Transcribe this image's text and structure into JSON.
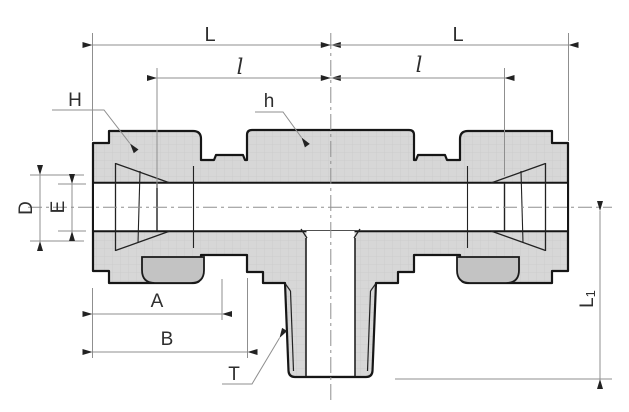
{
  "drawing": {
    "type": "technical-drawing",
    "subject": "compression tee fitting with male branch thread, dimensioned section view",
    "labels": {
      "L_left": "L",
      "L_right": "L",
      "l_left": "l",
      "l_right": "l",
      "H": "H",
      "h": "h",
      "D": "D",
      "E": "E",
      "A": "A",
      "B": "B",
      "T": "T",
      "L1_main": "L",
      "L1_sub": "1"
    },
    "colors": {
      "background": "#ffffff",
      "outline": "#1a1a1a",
      "body_fill": "#d7d7d7",
      "shadow_fill": "#c3c3c3",
      "dim_line": "#8f8f8f",
      "text": "#2e2e2e"
    }
  }
}
